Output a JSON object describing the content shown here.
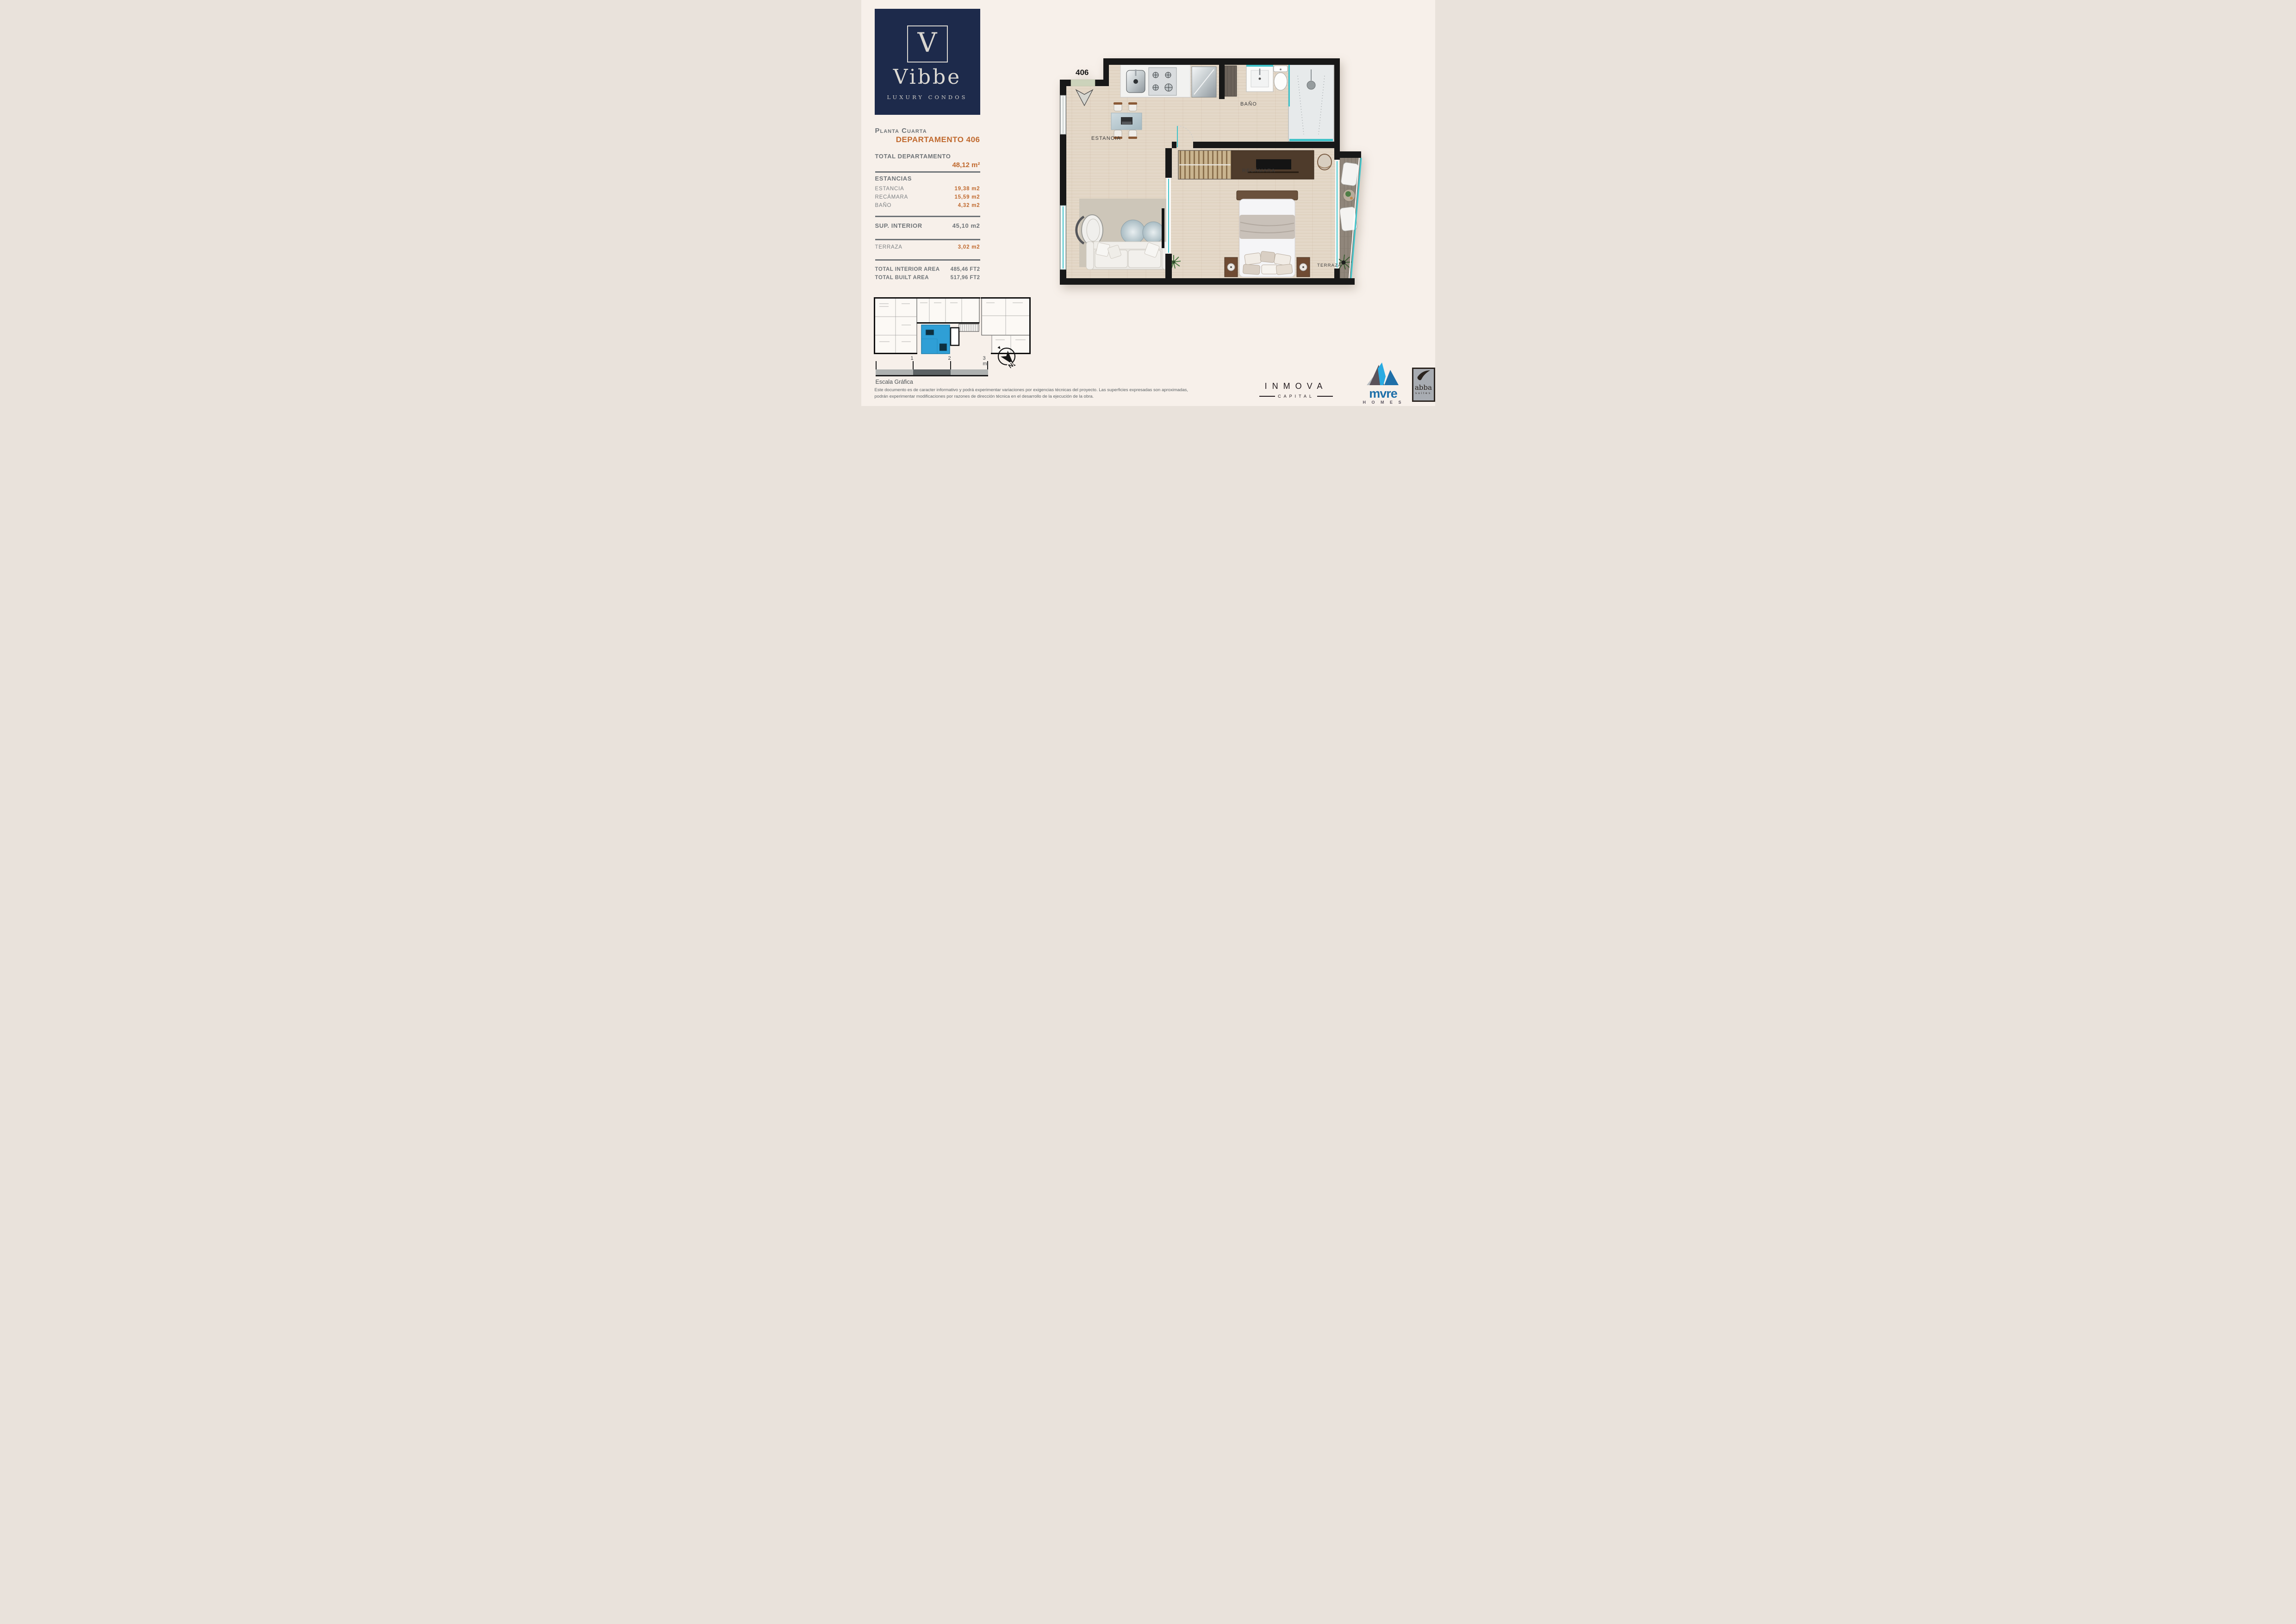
{
  "brand": {
    "initial": "V",
    "name": "Vibbe",
    "tagline": "LUXURY CONDOS"
  },
  "sidebar": {
    "floor_label": "Planta Cuarta",
    "unit_label": "DEPARTAMENTO 406",
    "total_label": "TOTAL DEPARTAMENTO",
    "total_value": "48,12 m²",
    "estancias_header": "ESTANCIAS",
    "rooms": [
      {
        "label": "ESTANCIA",
        "value": "19,38 m2"
      },
      {
        "label": "RECÁMARA",
        "value": "15,59 m2"
      },
      {
        "label": "BAÑO",
        "value": "4,32 m2"
      }
    ],
    "sup_interior": {
      "label": "SUP. INTERIOR",
      "value": "45,10 m2"
    },
    "terraza": {
      "label": "TERRAZA",
      "value": "3,02 m2"
    },
    "totals": [
      {
        "label": "TOTAL INTERIOR AREA",
        "value": "485,46 FT2"
      },
      {
        "label": "TOTAL BUILT AREA",
        "value": "517,96 FT2"
      }
    ]
  },
  "plan": {
    "unit_number": "406",
    "labels": {
      "estancia": "ESTANCIA",
      "bano": "BAÑO",
      "recamara": "RECÁMARA",
      "terraza": "TERRAZA"
    }
  },
  "scale_bar": {
    "ticks": [
      "1",
      "2",
      "3 m."
    ],
    "caption": "Escala Gráfica"
  },
  "compass": {
    "north": "N"
  },
  "disclaimer": {
    "line1": "Este documento es de caracter informativo y podrá experimentar variaciones por exigencias técnicas del proyecto. Las superficies expresadas son aproximadas,",
    "line2": "podrán experimentar modificaciones por razones de dirección técnica en el desarrollo de la ejecución de la obra."
  },
  "partners": {
    "inmova": {
      "name": "INMOVA",
      "sub": "CAPITAL"
    },
    "mvre": {
      "name": "mvre",
      "sub": "H O M E S"
    },
    "abba": {
      "name": "abba",
      "sub": "suites"
    }
  },
  "colors": {
    "accent_orange": "#C0692E",
    "text_gray": "#6E7377",
    "navy": "#1D2A4B",
    "teal_glass": "#3FC3C9",
    "highlight_blue": "#2F9FD6",
    "wall_black": "#181818"
  }
}
